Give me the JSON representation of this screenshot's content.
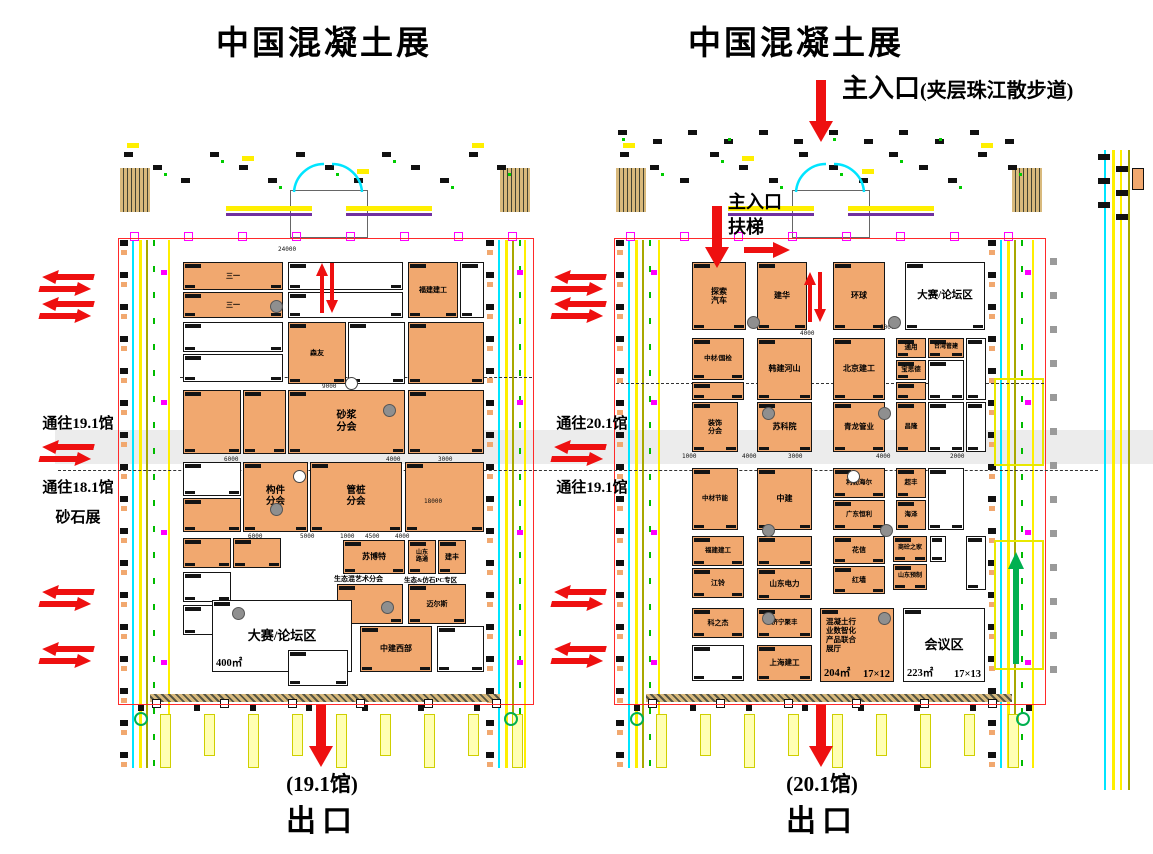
{
  "titles": {
    "left": "中国混凝土展",
    "right": "中国混凝土展"
  },
  "main_entrance": {
    "label": "主入口",
    "note": "(夹层珠江散步道)"
  },
  "inner_entrance": {
    "line1": "主入口",
    "line2": "扶梯"
  },
  "left_labels": {
    "to_19_1": "通往19.1馆",
    "to_18_1": "通往18.1馆",
    "sand": "砂石展"
  },
  "mid_labels": {
    "to_20_1": "通往20.1馆",
    "to_19_1": "通往19.1馆"
  },
  "exit_left": {
    "hall": "(19.1馆)",
    "label": "出口"
  },
  "exit_right": {
    "hall": "(20.1馆)",
    "label": "出口"
  },
  "colors": {
    "booth_orange": "#f1a86f",
    "arrow_red": "#ee1010",
    "outline_red": "#ff2a2a",
    "line_cyan": "#00e5ff",
    "line_yellow": "#ffef00",
    "line_olive": "#a8a800",
    "green": "#00b050",
    "magenta": "#ff00ff",
    "gray_band": "#ececec"
  },
  "halls": [
    {
      "name": "19.1馆",
      "outline": {
        "x": 118,
        "y": 238,
        "w": 414,
        "h": 465
      },
      "booths": [
        {
          "x": 183,
          "y": 262,
          "w": 100,
          "h": 28,
          "f": "o",
          "t": "三一",
          "fs": 7
        },
        {
          "x": 183,
          "y": 292,
          "w": 100,
          "h": 26,
          "f": "o",
          "t": "三一",
          "fs": 7
        },
        {
          "x": 288,
          "y": 262,
          "w": 115,
          "h": 28,
          "f": "w",
          "t": ""
        },
        {
          "x": 288,
          "y": 292,
          "w": 115,
          "h": 26,
          "f": "w",
          "t": ""
        },
        {
          "x": 408,
          "y": 262,
          "w": 50,
          "h": 56,
          "f": "o",
          "t": "福建建工",
          "fs": 7
        },
        {
          "x": 460,
          "y": 262,
          "w": 24,
          "h": 56,
          "f": "w",
          "t": ""
        },
        {
          "x": 183,
          "y": 322,
          "w": 100,
          "h": 30,
          "f": "w",
          "t": ""
        },
        {
          "x": 183,
          "y": 354,
          "w": 100,
          "h": 28,
          "f": "w",
          "t": ""
        },
        {
          "x": 288,
          "y": 322,
          "w": 58,
          "h": 62,
          "f": "o",
          "t": "森友",
          "fs": 7
        },
        {
          "x": 348,
          "y": 322,
          "w": 57,
          "h": 62,
          "f": "w",
          "t": ""
        },
        {
          "x": 408,
          "y": 322,
          "w": 76,
          "h": 62,
          "f": "o",
          "t": ""
        },
        {
          "x": 183,
          "y": 390,
          "w": 58,
          "h": 64,
          "f": "o",
          "t": ""
        },
        {
          "x": 243,
          "y": 390,
          "w": 43,
          "h": 64,
          "f": "o",
          "t": ""
        },
        {
          "x": 288,
          "y": 390,
          "w": 117,
          "h": 64,
          "f": "o",
          "t": "砂浆\n分会",
          "fs": 10
        },
        {
          "x": 408,
          "y": 390,
          "w": 76,
          "h": 64,
          "f": "o",
          "t": ""
        },
        {
          "x": 183,
          "y": 462,
          "w": 58,
          "h": 34,
          "f": "w",
          "t": ""
        },
        {
          "x": 183,
          "y": 498,
          "w": 58,
          "h": 34,
          "f": "o",
          "t": ""
        },
        {
          "x": 243,
          "y": 462,
          "w": 65,
          "h": 70,
          "f": "o",
          "t": "构件\n分会",
          "fs": 9.5
        },
        {
          "x": 310,
          "y": 462,
          "w": 92,
          "h": 70,
          "f": "o",
          "t": "管桩\n分会",
          "fs": 9.5
        },
        {
          "x": 405,
          "y": 462,
          "w": 79,
          "h": 70,
          "f": "o",
          "t": ""
        },
        {
          "x": 183,
          "y": 538,
          "w": 48,
          "h": 30,
          "f": "o",
          "t": ""
        },
        {
          "x": 233,
          "y": 538,
          "w": 48,
          "h": 30,
          "f": "o",
          "t": ""
        },
        {
          "x": 343,
          "y": 540,
          "w": 62,
          "h": 34,
          "f": "o",
          "t": "苏博特",
          "fs": 8
        },
        {
          "x": 408,
          "y": 540,
          "w": 28,
          "h": 34,
          "f": "o",
          "t": "山东\n路通",
          "fs": 6
        },
        {
          "x": 438,
          "y": 540,
          "w": 28,
          "h": 34,
          "f": "o",
          "t": "建丰",
          "fs": 7
        },
        {
          "x": 183,
          "y": 572,
          "w": 48,
          "h": 30,
          "f": "w",
          "t": ""
        },
        {
          "x": 183,
          "y": 605,
          "w": 48,
          "h": 30,
          "f": "w",
          "t": ""
        },
        {
          "x": 337,
          "y": 584,
          "w": 66,
          "h": 40,
          "f": "o",
          "t": ""
        },
        {
          "x": 408,
          "y": 584,
          "w": 58,
          "h": 40,
          "f": "o",
          "t": "迈尔斯",
          "fs": 7
        },
        {
          "x": 212,
          "y": 600,
          "w": 140,
          "h": 72,
          "f": "w",
          "t": "大赛/论坛区",
          "fs": 13,
          "a": "400㎡",
          "d": "16×25"
        },
        {
          "x": 360,
          "y": 626,
          "w": 72,
          "h": 46,
          "f": "o",
          "t": "中建西部",
          "fs": 8
        },
        {
          "x": 437,
          "y": 626,
          "w": 47,
          "h": 46,
          "f": "w",
          "t": ""
        },
        {
          "x": 288,
          "y": 650,
          "w": 60,
          "h": 36,
          "f": "w",
          "t": ""
        }
      ],
      "pillars": [
        [
          270,
          300
        ],
        [
          383,
          404
        ],
        [
          270,
          503
        ],
        [
          381,
          601
        ],
        [
          232,
          607
        ]
      ],
      "wpillars": [
        [
          293,
          470
        ],
        [
          345,
          377
        ]
      ],
      "texts": [
        [
          "生态混艺术分会",
          334,
          574,
          7
        ],
        [
          "生态&仿石PC专区",
          404,
          574,
          6.5
        ]
      ],
      "dims": [
        [
          "24000",
          278,
          246
        ],
        [
          "9000",
          322,
          383
        ],
        [
          "6000",
          224,
          456
        ],
        [
          "4000",
          386,
          456
        ],
        [
          "3000",
          438,
          456
        ],
        [
          "6000",
          248,
          533
        ],
        [
          "5000",
          300,
          533
        ],
        [
          "1000",
          340,
          533
        ],
        [
          "4500",
          365,
          533
        ],
        [
          "4000",
          395,
          533
        ],
        [
          "18000",
          424,
          498
        ]
      ]
    },
    {
      "name": "20.1馆",
      "outline": {
        "x": 614,
        "y": 238,
        "w": 430,
        "h": 465
      },
      "booths": [
        {
          "x": 692,
          "y": 262,
          "w": 54,
          "h": 68,
          "f": "o",
          "t": "探索\n汽车",
          "fs": 8
        },
        {
          "x": 757,
          "y": 262,
          "w": 50,
          "h": 68,
          "f": "o",
          "t": "建华",
          "fs": 8
        },
        {
          "x": 833,
          "y": 262,
          "w": 52,
          "h": 68,
          "f": "o",
          "t": "环球",
          "fs": 8
        },
        {
          "x": 905,
          "y": 262,
          "w": 80,
          "h": 68,
          "f": "w",
          "t": "大赛/论坛区",
          "fs": 10.5
        },
        {
          "x": 692,
          "y": 338,
          "w": 52,
          "h": 42,
          "f": "o",
          "t": "中材/国检",
          "fs": 6.5
        },
        {
          "x": 692,
          "y": 382,
          "w": 52,
          "h": 18,
          "f": "o",
          "t": ""
        },
        {
          "x": 757,
          "y": 338,
          "w": 55,
          "h": 62,
          "f": "o",
          "t": "韩建河山",
          "fs": 8
        },
        {
          "x": 833,
          "y": 338,
          "w": 52,
          "h": 62,
          "f": "o",
          "t": "北京建工",
          "fs": 8
        },
        {
          "x": 896,
          "y": 338,
          "w": 30,
          "h": 20,
          "f": "o",
          "t": "通用",
          "fs": 6.5
        },
        {
          "x": 928,
          "y": 338,
          "w": 36,
          "h": 20,
          "f": "o",
          "t": "台湾管建",
          "fs": 6
        },
        {
          "x": 896,
          "y": 360,
          "w": 30,
          "h": 20,
          "f": "o",
          "t": "宝思德",
          "fs": 6.5
        },
        {
          "x": 928,
          "y": 360,
          "w": 36,
          "h": 40,
          "f": "w",
          "t": ""
        },
        {
          "x": 896,
          "y": 382,
          "w": 30,
          "h": 18,
          "f": "o",
          "t": ""
        },
        {
          "x": 966,
          "y": 338,
          "w": 20,
          "h": 62,
          "f": "w",
          "t": ""
        },
        {
          "x": 692,
          "y": 402,
          "w": 46,
          "h": 50,
          "f": "o",
          "t": "装饰\n分会",
          "fs": 7
        },
        {
          "x": 757,
          "y": 402,
          "w": 55,
          "h": 50,
          "f": "o",
          "t": "苏科院",
          "fs": 8
        },
        {
          "x": 833,
          "y": 402,
          "w": 52,
          "h": 50,
          "f": "o",
          "t": "青龙管业",
          "fs": 7.5
        },
        {
          "x": 896,
          "y": 402,
          "w": 30,
          "h": 50,
          "f": "o",
          "t": "昌隆",
          "fs": 6.5
        },
        {
          "x": 928,
          "y": 402,
          "w": 36,
          "h": 50,
          "f": "w",
          "t": ""
        },
        {
          "x": 966,
          "y": 402,
          "w": 20,
          "h": 50,
          "f": "w",
          "t": ""
        },
        {
          "x": 692,
          "y": 468,
          "w": 46,
          "h": 62,
          "f": "o",
          "t": "中材节能",
          "fs": 6.5
        },
        {
          "x": 757,
          "y": 468,
          "w": 55,
          "h": 62,
          "f": "o",
          "t": "中建",
          "fs": 8
        },
        {
          "x": 833,
          "y": 468,
          "w": 52,
          "h": 30,
          "f": "o",
          "t": "利勃海尔",
          "fs": 6.5
        },
        {
          "x": 833,
          "y": 500,
          "w": 52,
          "h": 30,
          "f": "o",
          "t": "广东恒利",
          "fs": 6.5
        },
        {
          "x": 896,
          "y": 468,
          "w": 30,
          "h": 30,
          "f": "o",
          "t": "超丰",
          "fs": 6.5
        },
        {
          "x": 896,
          "y": 500,
          "w": 30,
          "h": 30,
          "f": "o",
          "t": "海泽",
          "fs": 6.5
        },
        {
          "x": 928,
          "y": 468,
          "w": 36,
          "h": 62,
          "f": "w",
          "t": ""
        },
        {
          "x": 692,
          "y": 536,
          "w": 52,
          "h": 30,
          "f": "o",
          "t": "福建建工",
          "fs": 6.5
        },
        {
          "x": 692,
          "y": 568,
          "w": 52,
          "h": 30,
          "f": "o",
          "t": "江铃",
          "fs": 7
        },
        {
          "x": 757,
          "y": 536,
          "w": 55,
          "h": 30,
          "f": "o",
          "t": ""
        },
        {
          "x": 757,
          "y": 568,
          "w": 55,
          "h": 32,
          "f": "o",
          "t": "山东电力",
          "fs": 7.5
        },
        {
          "x": 833,
          "y": 536,
          "w": 52,
          "h": 28,
          "f": "o",
          "t": "花信",
          "fs": 7
        },
        {
          "x": 833,
          "y": 566,
          "w": 52,
          "h": 28,
          "f": "o",
          "t": "红墙",
          "fs": 7
        },
        {
          "x": 893,
          "y": 536,
          "w": 34,
          "h": 26,
          "f": "o",
          "t": "商砼之家",
          "fs": 6
        },
        {
          "x": 930,
          "y": 536,
          "w": 16,
          "h": 26,
          "f": "w",
          "t": ""
        },
        {
          "x": 893,
          "y": 564,
          "w": 34,
          "h": 26,
          "f": "o",
          "t": "山东预制",
          "fs": 6
        },
        {
          "x": 966,
          "y": 536,
          "w": 20,
          "h": 54,
          "f": "w",
          "t": ""
        },
        {
          "x": 692,
          "y": 608,
          "w": 52,
          "h": 30,
          "f": "o",
          "t": "科之杰",
          "fs": 7
        },
        {
          "x": 757,
          "y": 608,
          "w": 55,
          "h": 30,
          "f": "o",
          "t": "济宁聚丰",
          "fs": 6.5
        },
        {
          "x": 757,
          "y": 645,
          "w": 55,
          "h": 36,
          "f": "o",
          "t": "上海建工",
          "fs": 7.5
        },
        {
          "x": 692,
          "y": 645,
          "w": 52,
          "h": 36,
          "f": "w",
          "t": ""
        },
        {
          "x": 820,
          "y": 608,
          "w": 74,
          "h": 74,
          "f": "o",
          "t": "混凝土行\n业数智化\n产品联合\n展厅",
          "fs": 7.5,
          "a": "204㎡",
          "d": "17×12",
          "al": "left"
        },
        {
          "x": 903,
          "y": 608,
          "w": 82,
          "h": 74,
          "f": "w",
          "t": "会议区",
          "fs": 13,
          "a": "223㎡",
          "d": "17×13"
        }
      ],
      "pillars": [
        [
          747,
          316
        ],
        [
          888,
          316
        ],
        [
          762,
          407
        ],
        [
          878,
          407
        ],
        [
          762,
          524
        ],
        [
          880,
          524
        ],
        [
          762,
          612
        ],
        [
          878,
          612
        ]
      ],
      "wpillars": [
        [
          847,
          470
        ]
      ],
      "texts": [],
      "dims": [
        [
          "6000",
          880,
          324
        ],
        [
          "4000",
          800,
          330
        ],
        [
          "1000",
          682,
          453
        ],
        [
          "4000",
          742,
          453
        ],
        [
          "3000",
          788,
          453
        ],
        [
          "4000",
          876,
          453
        ],
        [
          "2000",
          950,
          453
        ]
      ]
    }
  ],
  "arrows": [
    {
      "t": "swap",
      "x": 40,
      "y": 270
    },
    {
      "t": "swap",
      "x": 40,
      "y": 297
    },
    {
      "t": "swap",
      "x": 40,
      "y": 440
    },
    {
      "t": "swap",
      "x": 40,
      "y": 585
    },
    {
      "t": "swap",
      "x": 40,
      "y": 642
    },
    {
      "t": "swap",
      "x": 552,
      "y": 270
    },
    {
      "t": "swap",
      "x": 552,
      "y": 297
    },
    {
      "t": "swap",
      "x": 552,
      "y": 440
    },
    {
      "t": "swap",
      "x": 552,
      "y": 585
    },
    {
      "t": "swap",
      "x": 552,
      "y": 642
    },
    {
      "t": "vpair",
      "x": 316,
      "y": 263
    },
    {
      "t": "vpair",
      "x": 804,
      "y": 272
    },
    {
      "t": "down",
      "x": 702,
      "y": 206
    },
    {
      "t": "right",
      "x": 744,
      "y": 240
    },
    {
      "t": "down",
      "x": 806,
      "y": 80
    },
    {
      "t": "down",
      "x": 306,
      "y": 705
    },
    {
      "t": "down",
      "x": 806,
      "y": 705
    },
    {
      "t": "upg",
      "x": 1008,
      "y": 552
    }
  ]
}
